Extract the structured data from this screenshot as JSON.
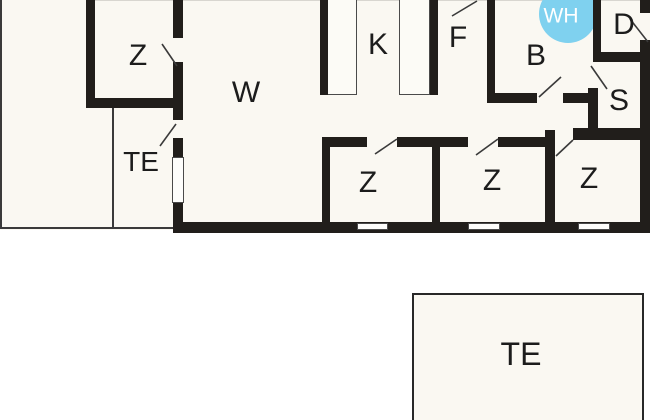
{
  "title": "Floor plan",
  "colors": {
    "wall": "#211e1b",
    "floor": "#faf8f2",
    "accent": "#7fd1ef",
    "wh_text": "#ffffff"
  },
  "rooms": [
    {
      "id": "room-z-top-left",
      "label": "Z"
    },
    {
      "id": "room-te-annex",
      "label": "TE"
    },
    {
      "id": "room-w-living",
      "label": "W"
    },
    {
      "id": "room-k-kitchen",
      "label": "K"
    },
    {
      "id": "room-f",
      "label": "F"
    },
    {
      "id": "room-b",
      "label": "B"
    },
    {
      "id": "water-heater",
      "label": "WH"
    },
    {
      "id": "room-d",
      "label": "D"
    },
    {
      "id": "room-s",
      "label": "S"
    },
    {
      "id": "room-z-1",
      "label": "Z"
    },
    {
      "id": "room-z-2",
      "label": "Z"
    },
    {
      "id": "room-z-3",
      "label": "Z"
    },
    {
      "id": "room-te-detached",
      "label": "TE"
    }
  ]
}
